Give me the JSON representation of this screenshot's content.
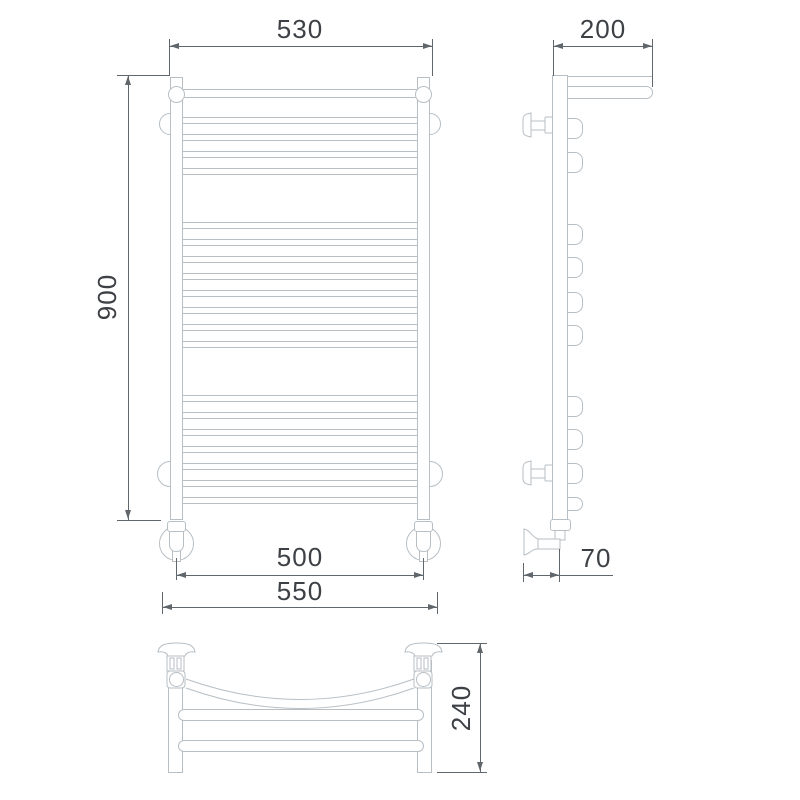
{
  "document": {
    "kind": "technical dimensional drawing",
    "subject": "ladder heated towel rail with shelf, three orthographic views"
  },
  "palette": {
    "background": "#ffffff",
    "object_line": "#b7bfc5",
    "dimension_line": "#5f666c",
    "text": "#3d4146"
  },
  "views": {
    "front": {
      "label": "front-view",
      "dimensions": {
        "top_width": "530",
        "height": "900",
        "pipe_spacing": "500",
        "overall_width": "550"
      }
    },
    "side": {
      "label": "side-view",
      "dimensions": {
        "shelf_depth": "200",
        "wall_offset": "70"
      }
    },
    "top": {
      "label": "top-view",
      "dimensions": {
        "depth": "240"
      }
    }
  }
}
